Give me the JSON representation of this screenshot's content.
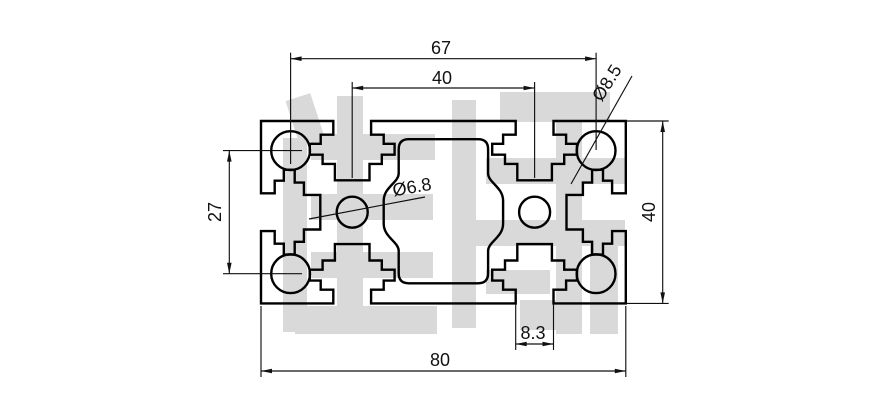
{
  "drawing": {
    "dimensions": {
      "corner_hole_spacing_horizontal": "67",
      "top_slot_spacing": "40",
      "corner_hole_diameter": "Ø8.5",
      "corner_hole_spacing_vertical": "27",
      "overall_height": "40",
      "center_hole_diameter": "Ø6.8",
      "slot_opening_width": "8.3",
      "overall_width": "80"
    },
    "colors": {
      "outline": "#000000",
      "dimension_lines": "#111111",
      "watermark": "#d9d9d9",
      "background": "#ffffff"
    }
  }
}
